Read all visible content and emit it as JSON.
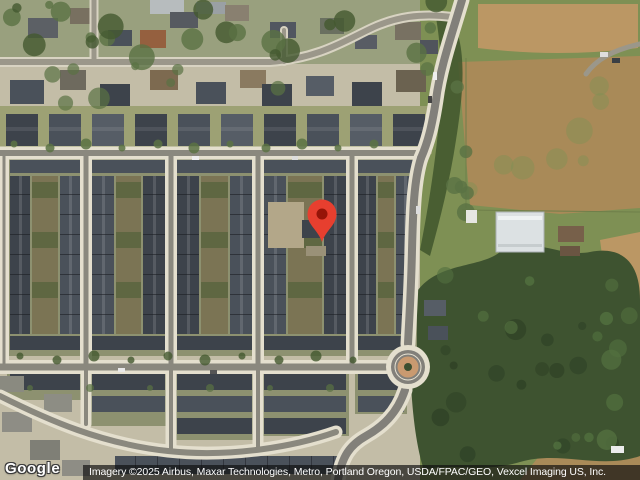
{
  "watermark": {
    "logo_text": "Google"
  },
  "attribution": {
    "text": "Imagery ©2025 Airbus, Maxar Technologies, Metro, Portland Oregon, USDA/FPAC/GEO, Vexcel Imaging US, Inc."
  },
  "marker": {
    "icon": "location-pin-icon",
    "color": "#e73f2f",
    "dot_color": "#961408"
  },
  "colors": {
    "ground": "#c3bda7",
    "topband": "#99a07e",
    "yard": "#8d9170",
    "yard2": "#9da174",
    "field": "#7e9054",
    "forest": "#3e5330",
    "forest_dark": "#2f4226",
    "forest_light": "#52703f",
    "dirt": "#bb9764",
    "dirt2": "#a98a58",
    "sidewalk": "#e4dfce",
    "asphalt": "#8a887e",
    "asphalt_main": "#82807a",
    "asphalt_old": "#9b978a",
    "sidewalk_old": "#d8d3c2",
    "roof_a": "#3d434b",
    "roof_b": "#4a515a",
    "roof_c": "#565d66",
    "roof_gray": "#8e8d85",
    "brick": "#c99a70",
    "tree": "#5a7243",
    "tree_dark": "#44592f",
    "center_strip": "#7b7454",
    "lot_dirt": "#b3a789",
    "building_white": "#dce1e3"
  }
}
